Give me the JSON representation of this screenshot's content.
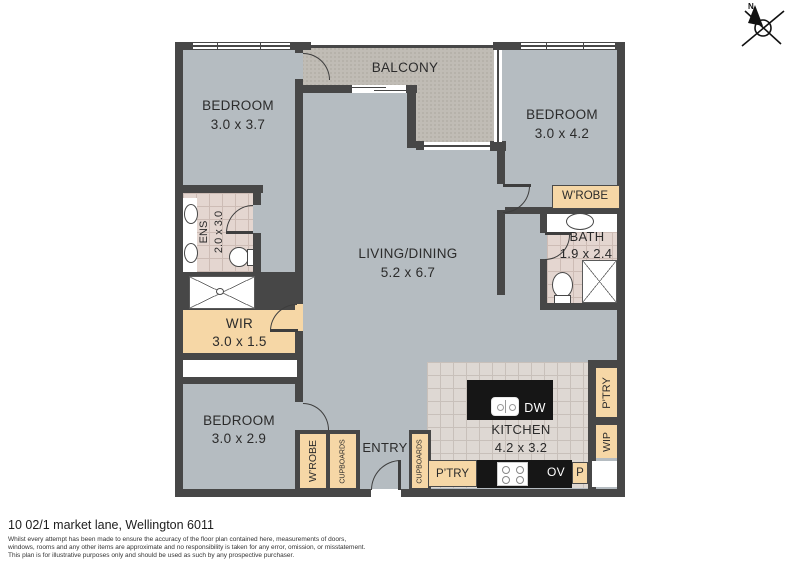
{
  "plan": {
    "balcony": {
      "label": "BALCONY"
    },
    "bedroom_top_left": {
      "label": "BEDROOM",
      "dims": "3.0 x 3.7"
    },
    "bedroom_top_right": {
      "label": "BEDROOM",
      "dims": "3.0 x 4.2"
    },
    "bedroom_bottom_left": {
      "label": "BEDROOM",
      "dims": "3.0 x 2.9"
    },
    "living_dining": {
      "label": "LIVING/DINING",
      "dims": "5.2 x 6.7"
    },
    "ensuite": {
      "label": "ENS",
      "dims": "2.0 x 3.0"
    },
    "bathroom": {
      "label": "BATH",
      "dims": "1.9 x 2.4"
    },
    "wir": {
      "label": "WIR",
      "dims": "3.0 x 1.5"
    },
    "kitchen": {
      "label": "KITCHEN",
      "dims": "4.2 x 3.2"
    },
    "entry": {
      "label": "ENTRY"
    },
    "wardrobe_bed2": {
      "label": "W’ROBE"
    },
    "wardrobe_bed3": {
      "label": "W’ROBE"
    },
    "cupboards_hall": {
      "label": "CUPBOARDS"
    },
    "cupboards_entry": {
      "label": "CUPBOARDS"
    },
    "pantry_kitchen": {
      "label": "P’TRY"
    },
    "pantry_right": {
      "label": "P’TRY"
    },
    "wip": {
      "label": "WIP"
    },
    "pantry_p": {
      "label": "P"
    },
    "dishwasher": {
      "label": "DW"
    },
    "oven": {
      "label": "OV"
    }
  },
  "compass": {
    "north": "N"
  },
  "footer": {
    "address": "10 02/1 market lane, Wellington 6011",
    "disclaimer": [
      "Whilst every attempt has been made to ensure the accuracy of the floor plan contained here, measurements of doors,",
      "windows, rooms and any other items are approximate and no responsibility is taken for any error, omission, or misstatement.",
      "This plan is for illustrative purposes only and should be used as such by any prospective purchaser."
    ]
  },
  "colors": {
    "floor": "#b5bcc1",
    "balcony": "#c0bcb5",
    "wall": "#474747",
    "cabinet": "#f6d7a6",
    "wet_tile": "#e4d6d0",
    "kitchen_tile": "#ded8d3",
    "counter": "#161616"
  }
}
